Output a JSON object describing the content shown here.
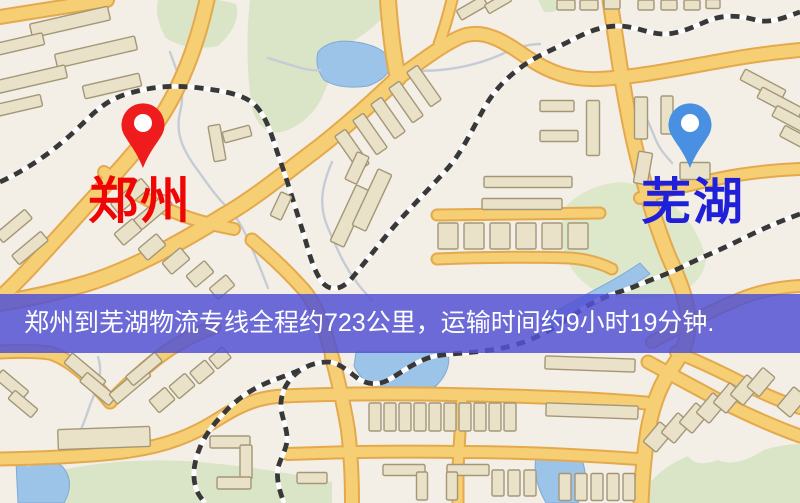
{
  "map": {
    "origin_city": {
      "name": "郑州",
      "label_color": "#f00505",
      "pin_color": "#ee1c1c"
    },
    "destination_city": {
      "name": "芜湖",
      "label_color": "#2020d8",
      "pin_color": "#4a90e2"
    },
    "banner": {
      "text": "郑州到芜湖物流专线全程约723公里，运输时间约9小时19分钟.",
      "background_color": "#5252d4",
      "text_color": "#ffffff"
    },
    "route": {
      "origin": "郑州",
      "destination": "芜湖",
      "distance_km": 723,
      "duration": "9小时19分钟"
    },
    "palette": {
      "background": "#f3efe6",
      "road_fill": "#f6ce74",
      "road_edge": "#e4a94c",
      "railway": "#383838",
      "water": "#9cc3e8",
      "park": "#d9e5c6",
      "building_fill": "#eae1c9",
      "building_outline": "#a39778"
    }
  }
}
